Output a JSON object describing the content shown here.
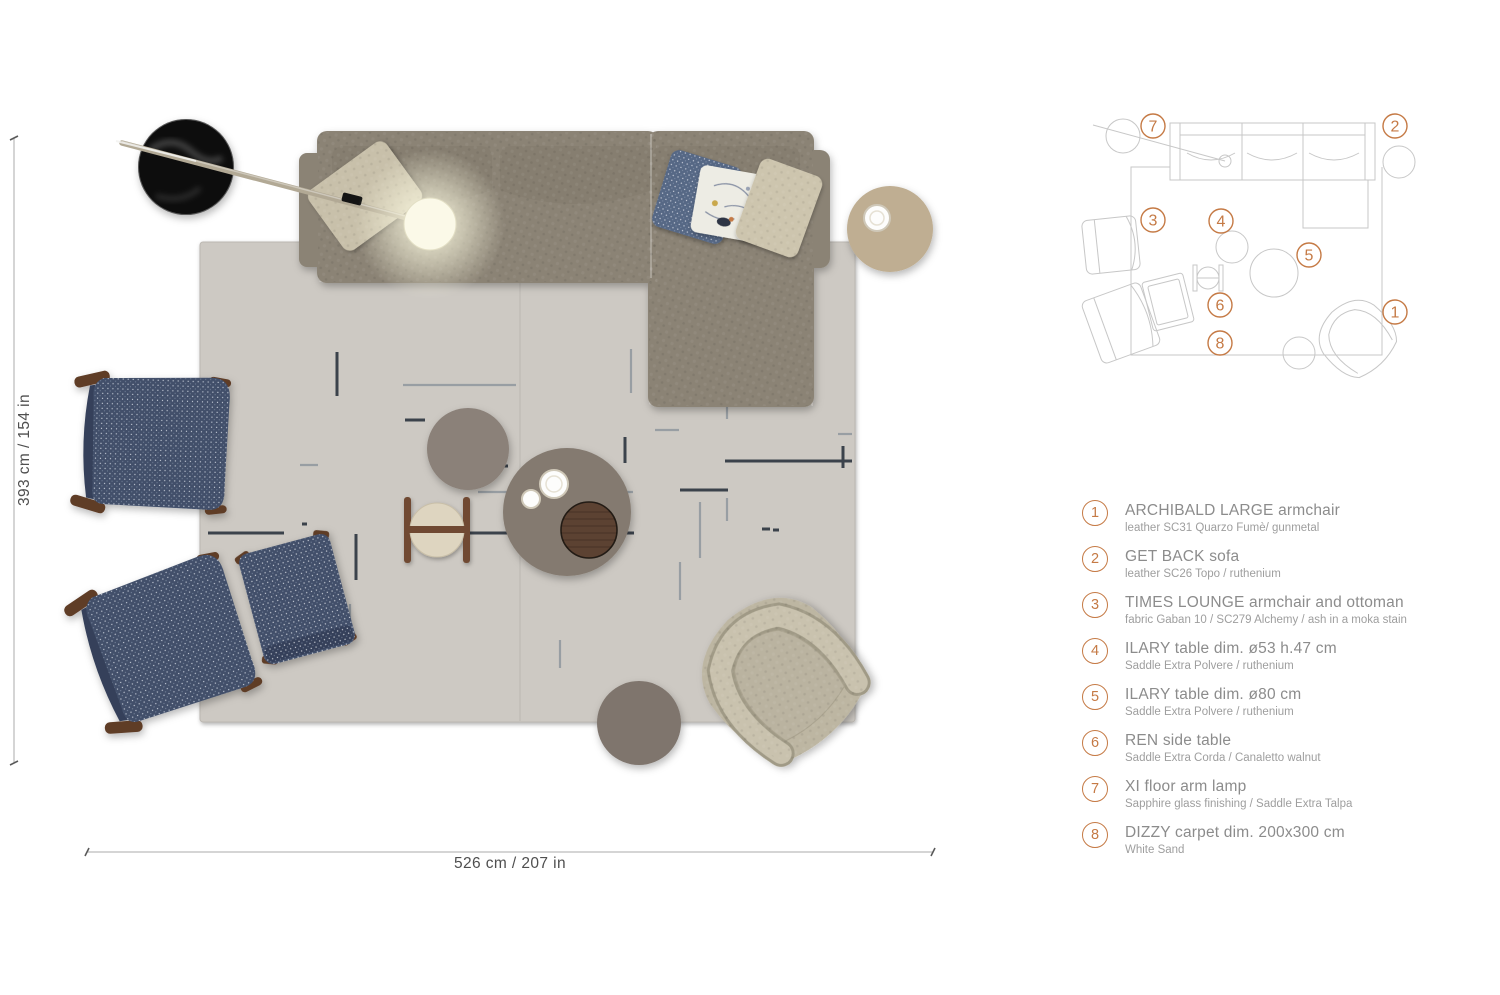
{
  "dimensions": {
    "vertical_label": "393 cm / 154 in",
    "horizontal_label": "526 cm / 207 in"
  },
  "minimap": {
    "callouts": [
      {
        "n": "1"
      },
      {
        "n": "2"
      },
      {
        "n": "3"
      },
      {
        "n": "4"
      },
      {
        "n": "5"
      },
      {
        "n": "6"
      },
      {
        "n": "7"
      },
      {
        "n": "8"
      }
    ]
  },
  "legend": {
    "items": [
      {
        "num": "1",
        "title": "ARCHIBALD LARGE armchair",
        "subtitle": "leather SC31 Quarzo Fumè/ gunmetal"
      },
      {
        "num": "2",
        "title": "GET BACK sofa",
        "subtitle": "leather SC26 Topo / ruthenium"
      },
      {
        "num": "3",
        "title": "TIMES LOUNGE armchair and ottoman",
        "subtitle": "fabric Gaban 10 / SC279 Alchemy / ash in a moka stain"
      },
      {
        "num": "4",
        "title": "ILARY table dim. ø53 h.47 cm",
        "subtitle": "Saddle Extra Polvere / ruthenium"
      },
      {
        "num": "5",
        "title": "ILARY table dim. ø80 cm",
        "subtitle": "Saddle Extra Polvere / ruthenium"
      },
      {
        "num": "6",
        "title": "REN side table",
        "subtitle": "Saddle Extra Corda / Canaletto walnut"
      },
      {
        "num": "7",
        "title": "XI floor arm lamp",
        "subtitle": "Sapphire glass finishing / Saddle Extra Talpa"
      },
      {
        "num": "8",
        "title": "DIZZY carpet dim. 200x300 cm",
        "subtitle": "White Sand"
      }
    ]
  },
  "colors": {
    "accent": "#c57a45",
    "sofa": "#8b8375",
    "sofa_cushion": "#867e70",
    "navy": "#42506a",
    "navy_band": "#35415a",
    "navy_light": "#566885",
    "wood": "#5e3c28",
    "carpet": "#cdc9c3",
    "carpet_edge": "#bcb8b2",
    "carpet_dash_dark": "#3a434b",
    "carpet_dash_light": "#989ea3",
    "archibald": "#bdb6a2",
    "archibald_band": "#c9c2ae",
    "archibald_band_edge": "#a09a86",
    "table_beige": "#bfae92",
    "table_gray": "#7f756d",
    "ilary53": "#8b8179",
    "ilary80": "#847a6f",
    "tray_wood": "#5c4233",
    "ren_plate": "#ded5c0",
    "ren_wood": "#6f4a31",
    "lamp_arm": "#b2a995",
    "lamp_base": "#0e0e0e",
    "glow": "#fbf9e8",
    "pillow_beige": "#c8c0aa",
    "pillow_beige2": "#cdc5ae",
    "pillow_floral": "#edece4",
    "minimap_line": "#c7c7c7",
    "dim_text": "#4f4f4f",
    "legend_title": "#8c8c8c",
    "legend_sub": "#9e9e9e"
  }
}
